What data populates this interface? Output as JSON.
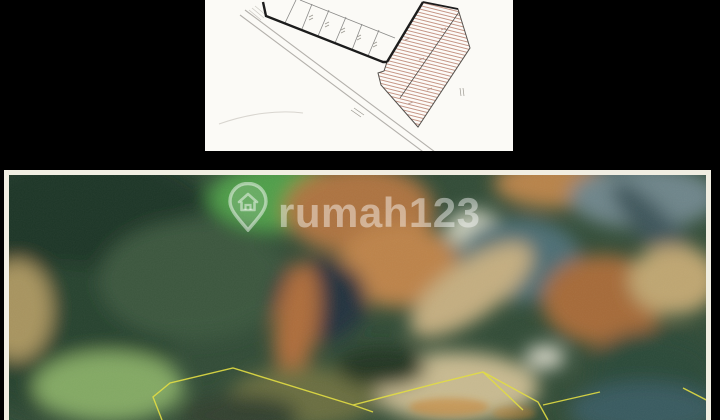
{
  "page": {
    "background": "#000000",
    "width_px": 720,
    "height_px": 420
  },
  "site_plan_panel": {
    "background": "#fbfaf6",
    "road_line_color": "#b3b0ab",
    "boundary_color": "#1c1c1c",
    "parcel_line_color": "#8a8a88",
    "survey_outline_color": "#55514d",
    "hatch_color": "#c08e7d",
    "annotation_color": "#9a978f",
    "faint_contour_color": "#d8d5cf"
  },
  "photo_panel": {
    "frame_color": "#f1eee2",
    "base_color": "#314b36",
    "property_boundary_color": "#e3de3f",
    "ground_label_color": "#c8822f",
    "watermark": {
      "brand_text": "rumah123",
      "icon": "house-pin-icon",
      "text_color": "rgba(255,255,255,0.44)"
    }
  }
}
